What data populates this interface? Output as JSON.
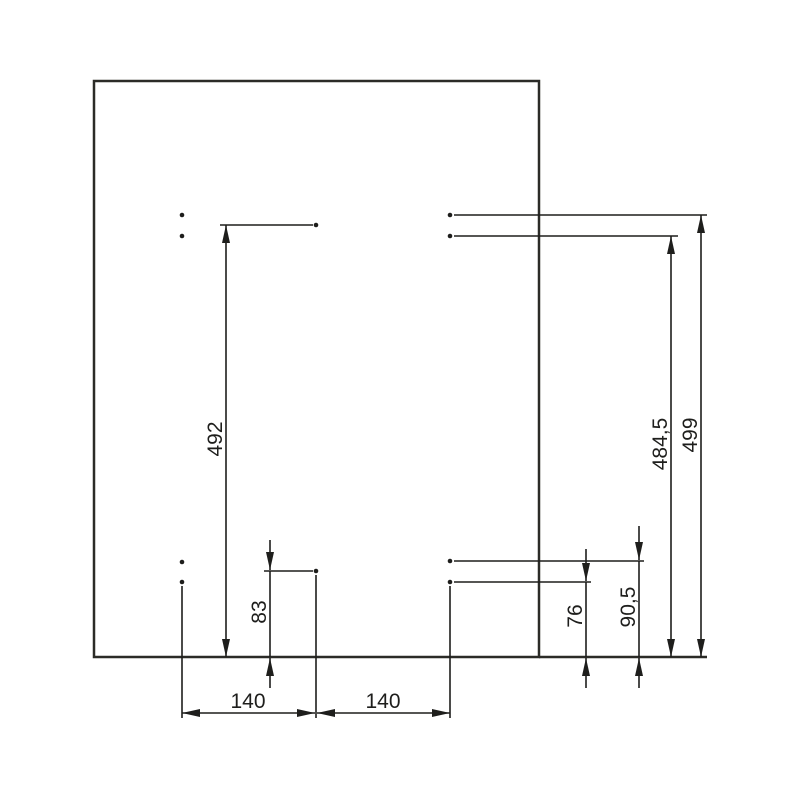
{
  "drawing": {
    "kind": "panel-drilling-dimension-diagram",
    "colors": {
      "panel_fill": "#FAEECD",
      "line": "#1E1E1C",
      "background": "#FFFFFF"
    },
    "dimensions": {
      "d492": "492",
      "d484_5": "484,5",
      "d499": "499",
      "d83": "83",
      "d76": "76",
      "d90_5": "90,5",
      "d140_left": "140",
      "d140_right": "140"
    }
  }
}
